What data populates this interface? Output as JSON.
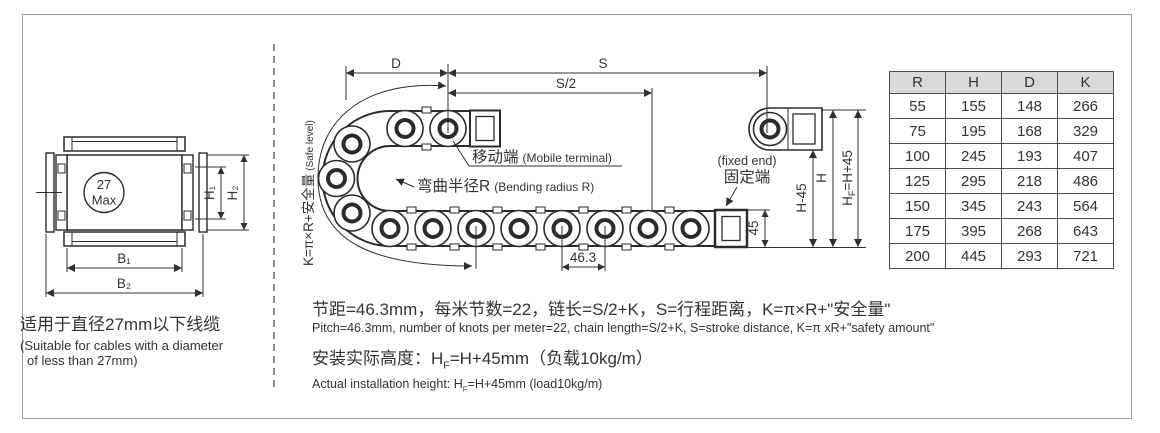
{
  "left_view": {
    "circle_label_line1": "27",
    "circle_label_line2": "Max",
    "dims": {
      "h1": "H₁",
      "h2": "H₂",
      "b1": "B₁",
      "b2": "B₂"
    },
    "caption_cn": "适用于直径27mm以下线缆",
    "caption_en_line1": "(Suitable for cables with a diameter",
    "caption_en_line2": "of less than 27mm)"
  },
  "side_view": {
    "safe_level_label_cn": "K=π×R+安全量",
    "safe_level_label_en": "(Safe level)",
    "dim_d": "D",
    "dim_s": "S",
    "dim_s2": "S/2",
    "dim_pitch": "46.3",
    "dim_45": "45",
    "dim_h45": "H-45",
    "dim_h": "H",
    "dim_hf": {
      "base": "H",
      "sub": "F",
      "rest": "=H+45"
    },
    "mobile_terminal_cn": "移动端",
    "mobile_terminal_en": "(Mobile terminal)",
    "bending_radius_cn": "弯曲半径R",
    "bending_radius_en": "(Bending radius R)",
    "fixed_end_en": "(fixed end)",
    "fixed_end_cn": "固定端"
  },
  "notes": {
    "line1_cn": "节距=46.3mm，每米节数=22，链长=S/2+K，S=行程距离，K=π×R+\"安全量\"",
    "line1_en": "Pitch=46.3mm, number of knots per meter=22, chain length=S/2+K, S=stroke distance, K=π xR+\"safety amount\"",
    "line2_cn_prefix": "安装实际高度：H",
    "line2_cn_sub": "F",
    "line2_cn_rest": "=H+45mm（负载10kg/m）",
    "line2_en_prefix": "Actual installation height: H",
    "line2_en_sub": "F",
    "line2_en_rest": "=H+45mm (load10kg/m)"
  },
  "table": {
    "columns": [
      "R",
      "H",
      "D",
      "K"
    ],
    "rows": [
      [
        55,
        155,
        148,
        266
      ],
      [
        75,
        195,
        168,
        329
      ],
      [
        100,
        245,
        193,
        407
      ],
      [
        125,
        295,
        218,
        486
      ],
      [
        150,
        345,
        243,
        564
      ],
      [
        175,
        395,
        268,
        643
      ],
      [
        200,
        445,
        293,
        721
      ]
    ]
  },
  "colors": {
    "line": "#2b2b2b",
    "table_header_bg": "#d9d9d9",
    "table_border": "#4d4d4d",
    "frame_border": "#9c9c9c"
  }
}
